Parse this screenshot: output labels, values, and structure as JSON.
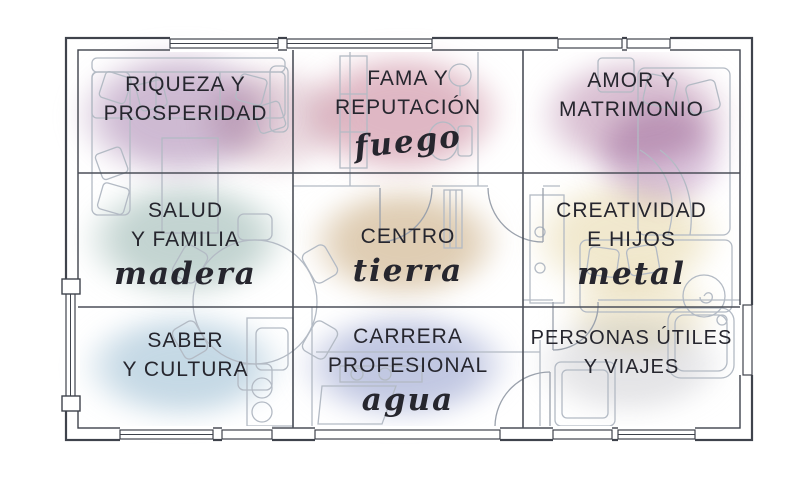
{
  "diagram_title": "Mapa bagua feng shui sobre plano de vivienda",
  "cells": [
    {
      "id": "riqueza",
      "lines": [
        "RIQUEZA Y",
        "PROSPERIDAD"
      ],
      "element": "",
      "color": "#c0a6c6"
    },
    {
      "id": "fama",
      "lines": [
        "FAMA Y",
        "REPUTACIÓN"
      ],
      "element": "fuego",
      "color": "#d6a3b3"
    },
    {
      "id": "amor",
      "lines": [
        "AMOR Y",
        "MATRIMONIO"
      ],
      "element": "",
      "color": "#cfaec6"
    },
    {
      "id": "salud",
      "lines": [
        "SALUD",
        "Y FAMILIA"
      ],
      "element": "madera",
      "color": "#b2c8c4"
    },
    {
      "id": "centro",
      "lines": [
        "CENTRO"
      ],
      "element": "tierra",
      "color": "#d6bf9e"
    },
    {
      "id": "creatividad",
      "lines": [
        "CREATIVIDAD",
        "E HIJOS"
      ],
      "element": "metal",
      "color": "#ebdfb9"
    },
    {
      "id": "saber",
      "lines": [
        "SABER",
        "Y CULTURA"
      ],
      "element": "",
      "color": "#b5cede"
    },
    {
      "id": "carrera",
      "lines": [
        "CARRERA",
        "PROFESIONAL"
      ],
      "element": "agua",
      "color": "#b0b8da"
    },
    {
      "id": "personas",
      "lines": [
        "PERSONAS ÚTILES",
        "Y VIAJES"
      ],
      "element": "",
      "color": "#d4d4d8"
    }
  ],
  "accents": [
    {
      "name": "riqueza-pink",
      "color": "#dcc0cb"
    },
    {
      "name": "amor-purple",
      "color": "#bd94bf"
    },
    {
      "name": "creatividad-spill",
      "color": "#e9ddb5"
    }
  ],
  "palette": {
    "wall_line": "#3f434c",
    "grid_line": "#4b4f58",
    "furniture_line": "#b3bac4",
    "text": "#26262e"
  }
}
